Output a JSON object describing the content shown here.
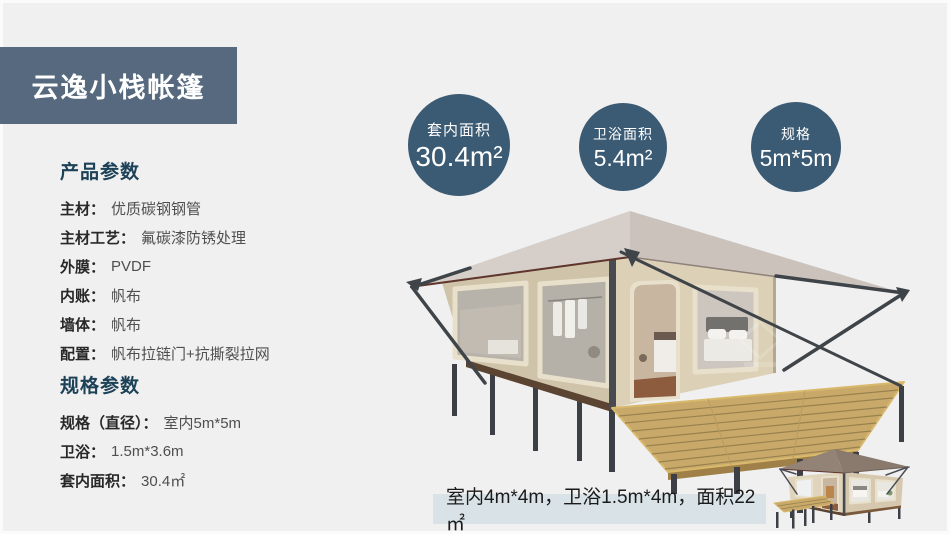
{
  "title_banner": {
    "text": "云逸小栈帐篷"
  },
  "stat_circles": [
    {
      "label": "套内面积",
      "value": "30.4m²"
    },
    {
      "label": "卫浴面积",
      "value": "5.4m²"
    },
    {
      "label": "规格",
      "value": "5m*5m"
    }
  ],
  "product_params": {
    "heading": "产品参数",
    "rows": [
      {
        "label": "主材：",
        "value": "优质碳钢钢管"
      },
      {
        "label": "主材工艺：",
        "value": "氟碳漆防锈处理"
      },
      {
        "label": "外膜：",
        "value": "PVDF"
      },
      {
        "label": "内账：",
        "value": "帆布"
      },
      {
        "label": "墙体：",
        "value": "帆布"
      },
      {
        "label": "配置：",
        "value": "帆布拉链门+抗撕裂拉网"
      }
    ]
  },
  "spec_params": {
    "heading": "规格参数",
    "rows": [
      {
        "label": "规格（直径）：",
        "value": "室内5m*5m"
      },
      {
        "label": "卫浴：",
        "value": "1.5m*3.6m"
      },
      {
        "label": "套内面积：",
        "value": "30.4㎡"
      }
    ]
  },
  "caption": {
    "text": "室内4m*4m，卫浴1.5m*4m，面积22㎡"
  },
  "images": {
    "main_tent": "glamping-tent-3d-render-with-deck",
    "thumbnail_tent": "small-glamping-tent-3d-render"
  },
  "colors": {
    "page_bg": "#f0f0f1",
    "banner_bg": "#56697e",
    "circle_bg": "#3b5a73",
    "heading_text": "#1d4257",
    "caption_bg": "#d9e3e7",
    "tent_canvas": "#d5c9ae",
    "tent_roof": "#d2c9c3",
    "deck_wood": "#c9a96a"
  }
}
